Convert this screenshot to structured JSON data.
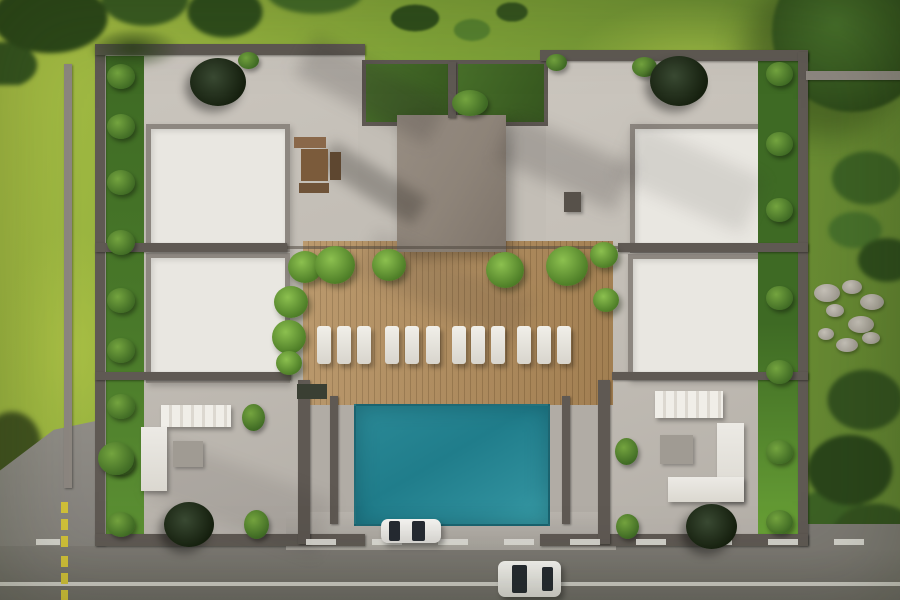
{
  "palette": {
    "lawn": "#82a539",
    "lawn-bright": "#a9bf45",
    "lawn-dark": "#5e8030",
    "concrete": "#c7c2ba",
    "roof": "#e9e7e1",
    "wall": "#5f5953",
    "wall-light": "#8d8780",
    "core": "#8d8378",
    "wood": "#b38e5d",
    "wood-dark": "#99774a",
    "pool": "#2e8e9b",
    "pool-deep": "#207d8b",
    "garden-green": "#35551e",
    "strip": "#4a7a2a",
    "strip-bright": "#69a136",
    "tree-dark": "#16200f",
    "asphalt": "#7c7973",
    "asphalt-dark": "#6e6b66",
    "line-white": "#dcdad4",
    "line-yellow": "#d2c23a",
    "furn": "#eceae5",
    "rock": "#b6b1a8",
    "glass": "#252a31"
  },
  "scene": {
    "left_bushes": [
      {
        "x": 107,
        "y": 64,
        "w": 28,
        "h": 25
      },
      {
        "x": 107,
        "y": 114,
        "w": 28,
        "h": 25
      },
      {
        "x": 107,
        "y": 170,
        "w": 28,
        "h": 25
      },
      {
        "x": 107,
        "y": 230,
        "w": 28,
        "h": 25
      },
      {
        "x": 107,
        "y": 288,
        "w": 28,
        "h": 25
      },
      {
        "x": 107,
        "y": 338,
        "w": 28,
        "h": 25
      },
      {
        "x": 107,
        "y": 394,
        "w": 28,
        "h": 25
      },
      {
        "x": 107,
        "y": 450,
        "w": 28,
        "h": 25
      },
      {
        "x": 107,
        "y": 512,
        "w": 28,
        "h": 25
      }
    ],
    "right_bushes": [
      {
        "x": 766,
        "y": 62,
        "w": 27,
        "h": 24
      },
      {
        "x": 766,
        "y": 132,
        "w": 27,
        "h": 24
      },
      {
        "x": 766,
        "y": 198,
        "w": 27,
        "h": 24
      },
      {
        "x": 766,
        "y": 286,
        "w": 27,
        "h": 24
      },
      {
        "x": 766,
        "y": 360,
        "w": 27,
        "h": 24
      },
      {
        "x": 766,
        "y": 440,
        "w": 27,
        "h": 24
      },
      {
        "x": 766,
        "y": 510,
        "w": 27,
        "h": 24
      }
    ],
    "top_bushes": [
      {
        "x": 238,
        "y": 52,
        "w": 21,
        "h": 17
      },
      {
        "x": 546,
        "y": 54,
        "w": 21,
        "h": 17
      },
      {
        "x": 632,
        "y": 57,
        "w": 25,
        "h": 20
      },
      {
        "x": 452,
        "y": 90,
        "w": 36,
        "h": 26
      }
    ],
    "courtyard_bushes": [
      {
        "x": 242,
        "y": 404,
        "w": 23,
        "h": 27
      },
      {
        "x": 244,
        "y": 510,
        "w": 25,
        "h": 29
      },
      {
        "x": 615,
        "y": 438,
        "w": 23,
        "h": 27
      },
      {
        "x": 616,
        "y": 514,
        "w": 23,
        "h": 25
      },
      {
        "x": 98,
        "y": 442,
        "w": 36,
        "h": 33
      }
    ],
    "deck_trees": [
      {
        "x": 288,
        "y": 251,
        "w": 34,
        "h": 32
      },
      {
        "x": 315,
        "y": 246,
        "w": 40,
        "h": 38
      },
      {
        "x": 372,
        "y": 249,
        "w": 34,
        "h": 32
      },
      {
        "x": 486,
        "y": 252,
        "w": 38,
        "h": 36
      },
      {
        "x": 546,
        "y": 246,
        "w": 42,
        "h": 40
      },
      {
        "x": 274,
        "y": 286,
        "w": 34,
        "h": 32
      },
      {
        "x": 272,
        "y": 320,
        "w": 34,
        "h": 34
      },
      {
        "x": 276,
        "y": 351,
        "w": 26,
        "h": 24
      },
      {
        "x": 590,
        "y": 242,
        "w": 28,
        "h": 26
      },
      {
        "x": 593,
        "y": 288,
        "w": 26,
        "h": 24
      }
    ],
    "dark_trees": [
      {
        "x": 190,
        "y": 58,
        "w": 56,
        "h": 48
      },
      {
        "x": 650,
        "y": 56,
        "w": 58,
        "h": 50
      },
      {
        "x": 164,
        "y": 502,
        "w": 50,
        "h": 45
      },
      {
        "x": 686,
        "y": 504,
        "w": 51,
        "h": 45
      }
    ],
    "loungers": [
      {
        "x": 317,
        "y": 326,
        "w": 14,
        "h": 38
      },
      {
        "x": 337,
        "y": 326,
        "w": 14,
        "h": 38
      },
      {
        "x": 357,
        "y": 326,
        "w": 14,
        "h": 38
      },
      {
        "x": 385,
        "y": 326,
        "w": 14,
        "h": 38
      },
      {
        "x": 405,
        "y": 326,
        "w": 14,
        "h": 38
      },
      {
        "x": 426,
        "y": 326,
        "w": 14,
        "h": 38
      },
      {
        "x": 452,
        "y": 326,
        "w": 14,
        "h": 38
      },
      {
        "x": 471,
        "y": 326,
        "w": 14,
        "h": 38
      },
      {
        "x": 491,
        "y": 326,
        "w": 14,
        "h": 38
      },
      {
        "x": 517,
        "y": 326,
        "w": 14,
        "h": 38
      },
      {
        "x": 537,
        "y": 326,
        "w": 14,
        "h": 38
      },
      {
        "x": 557,
        "y": 326,
        "w": 14,
        "h": 38
      }
    ],
    "rocks": [
      {
        "x": 814,
        "y": 284,
        "w": 26,
        "h": 18
      },
      {
        "x": 842,
        "y": 280,
        "w": 20,
        "h": 14
      },
      {
        "x": 860,
        "y": 294,
        "w": 24,
        "h": 16
      },
      {
        "x": 826,
        "y": 304,
        "w": 18,
        "h": 13
      },
      {
        "x": 848,
        "y": 316,
        "w": 26,
        "h": 17
      },
      {
        "x": 818,
        "y": 328,
        "w": 16,
        "h": 12
      },
      {
        "x": 836,
        "y": 338,
        "w": 22,
        "h": 14
      },
      {
        "x": 862,
        "y": 332,
        "w": 18,
        "h": 12
      }
    ],
    "yellow_dashes": [
      {
        "x": 61,
        "y": 502,
        "w": 7,
        "h": 11
      },
      {
        "x": 61,
        "y": 519,
        "w": 7,
        "h": 11
      },
      {
        "x": 61,
        "y": 536,
        "w": 7,
        "h": 11
      },
      {
        "x": 61,
        "y": 556,
        "w": 7,
        "h": 11
      },
      {
        "x": 61,
        "y": 573,
        "w": 7,
        "h": 11
      },
      {
        "x": 61,
        "y": 590,
        "w": 7,
        "h": 11
      }
    ],
    "white_dashes": [
      {
        "x": 36,
        "y": 539,
        "w": 24,
        "h": 6
      },
      {
        "x": 306,
        "y": 539,
        "w": 30,
        "h": 6
      },
      {
        "x": 372,
        "y": 539,
        "w": 30,
        "h": 6
      },
      {
        "x": 438,
        "y": 539,
        "w": 30,
        "h": 6
      },
      {
        "x": 504,
        "y": 539,
        "w": 30,
        "h": 6
      },
      {
        "x": 570,
        "y": 539,
        "w": 30,
        "h": 6
      },
      {
        "x": 636,
        "y": 539,
        "w": 30,
        "h": 6
      },
      {
        "x": 702,
        "y": 539,
        "w": 30,
        "h": 6
      },
      {
        "x": 768,
        "y": 539,
        "w": 30,
        "h": 6
      },
      {
        "x": 834,
        "y": 539,
        "w": 30,
        "h": 6
      }
    ]
  }
}
